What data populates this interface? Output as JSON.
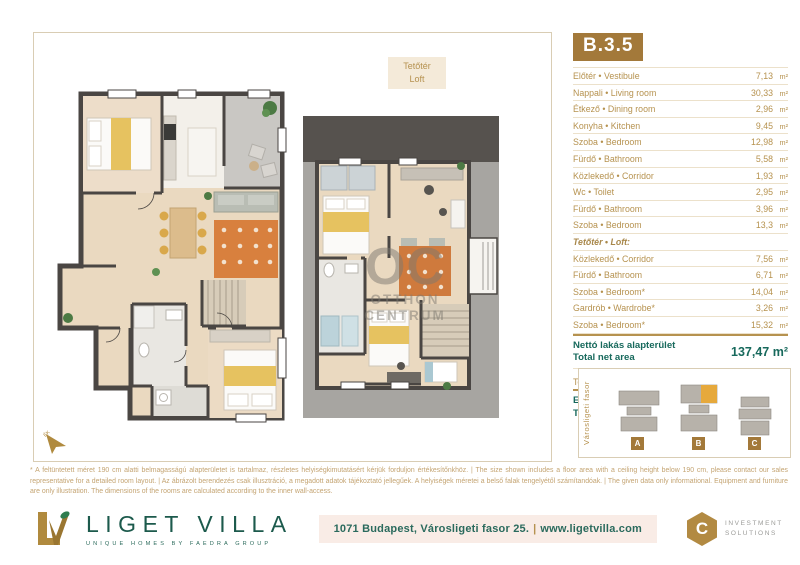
{
  "unit": {
    "code": "B.3.5"
  },
  "plan_labels": {
    "loft_line1": "Tetőtér",
    "loft_line2": "Loft"
  },
  "watermark": {
    "initials": "OC",
    "line1": "OTTHON",
    "line2": "CENTRUM"
  },
  "table": {
    "rows": [
      {
        "label": "Előtér • Vestibule",
        "value": "7,13",
        "unit": "m²",
        "section": false
      },
      {
        "label": "Nappali • Living room",
        "value": "30,33",
        "unit": "m²",
        "section": false
      },
      {
        "label": "Étkező • Dining room",
        "value": "2,96",
        "unit": "m²",
        "section": false
      },
      {
        "label": "Konyha • Kitchen",
        "value": "9,45",
        "unit": "m²",
        "section": false
      },
      {
        "label": "Szoba • Bedroom",
        "value": "12,98",
        "unit": "m²",
        "section": false
      },
      {
        "label": "Fürdő • Bathroom",
        "value": "5,58",
        "unit": "m²",
        "section": false
      },
      {
        "label": "Közlekedő • Corridor",
        "value": "1,93",
        "unit": "m²",
        "section": false
      },
      {
        "label": "Wc • Toilet",
        "value": "2,95",
        "unit": "m²",
        "section": false
      },
      {
        "label": "Fürdő • Bathroom",
        "value": "3,96",
        "unit": "m²",
        "section": false
      },
      {
        "label": "Szoba • Bedroom",
        "value": "13,3",
        "unit": "m²",
        "section": false
      },
      {
        "label": "Tetőtér • Loft:",
        "value": "",
        "unit": "",
        "section": true
      },
      {
        "label": "Közlekedő • Corridor",
        "value": "7,56",
        "unit": "m²",
        "section": false
      },
      {
        "label": "Fürdő • Bathroom",
        "value": "6,71",
        "unit": "m²",
        "section": false
      },
      {
        "label": "Szoba • Bedroom*",
        "value": "14,04",
        "unit": "m²",
        "section": false
      },
      {
        "label": "Gardrób • Wardrobe*",
        "value": "3,26",
        "unit": "m²",
        "section": false
      },
      {
        "label": "Szoba • Bedroom*",
        "value": "15,32",
        "unit": "m²",
        "section": false
      }
    ],
    "net": {
      "label_hu": "Nettó lakás alapterület",
      "label_en": "Total net area",
      "value": "137,47 m²"
    },
    "terrace": {
      "label": "Terasz • Terrace",
      "value": "9,24",
      "unit": "m²"
    },
    "total": {
      "label_hu": "Eladható összterület",
      "label_en": "Total area",
      "value": "142,09 m²"
    }
  },
  "siteplan": {
    "street_label": "Városligeti fasor",
    "buildings": [
      "A",
      "B",
      "C"
    ]
  },
  "disclaimer": "* A feltüntetett méret 190 cm alatti belmagasságú alapterületet is tartalmaz, részletes helyiségkimutatásért kérjük forduljon értékesítőnkhöz.  |  The size shown includes a floor area with a ceiling height below 190 cm, please contact our sales representative for a detailed room layout.  |  Az ábrázolt berendezés csak illusztráció, a megadott adatok tájékoztató jellegűek. A helyiségek méretei a belső falak tengelyétől számítandóak.  |  The given data only informational. Equipment and furniture are only illustration. The dimensions of the rooms are calculated according to the inner wall-access.",
  "footer": {
    "brand": "LIGET VILLA",
    "brand_sub": "UNIQUE HOMES BY FAEDRA GROUP",
    "logo_initials": "LV",
    "address": "1071 Budapest, Városligeti fasor 25.",
    "separator": "|",
    "website": "www.ligetvilla.com",
    "partner1_icon": "C",
    "partner1_line1": "INVESTMENT",
    "partner1_line2": "SOLUTIONS",
    "partner2_icon": "F",
    "partner2_name": "faedra",
    "partner2_sub": "GROUP"
  },
  "colors": {
    "gold": "#a3793a",
    "table_text": "#b6924f",
    "teal": "#17695c",
    "brand_green": "#1c5a4c",
    "wall": "#4a4643",
    "wood_floor": "#ead9c0",
    "roof_gray": "#a7a5a1",
    "rug_orange": "#d8803e",
    "address_bg": "#f9ece6"
  }
}
